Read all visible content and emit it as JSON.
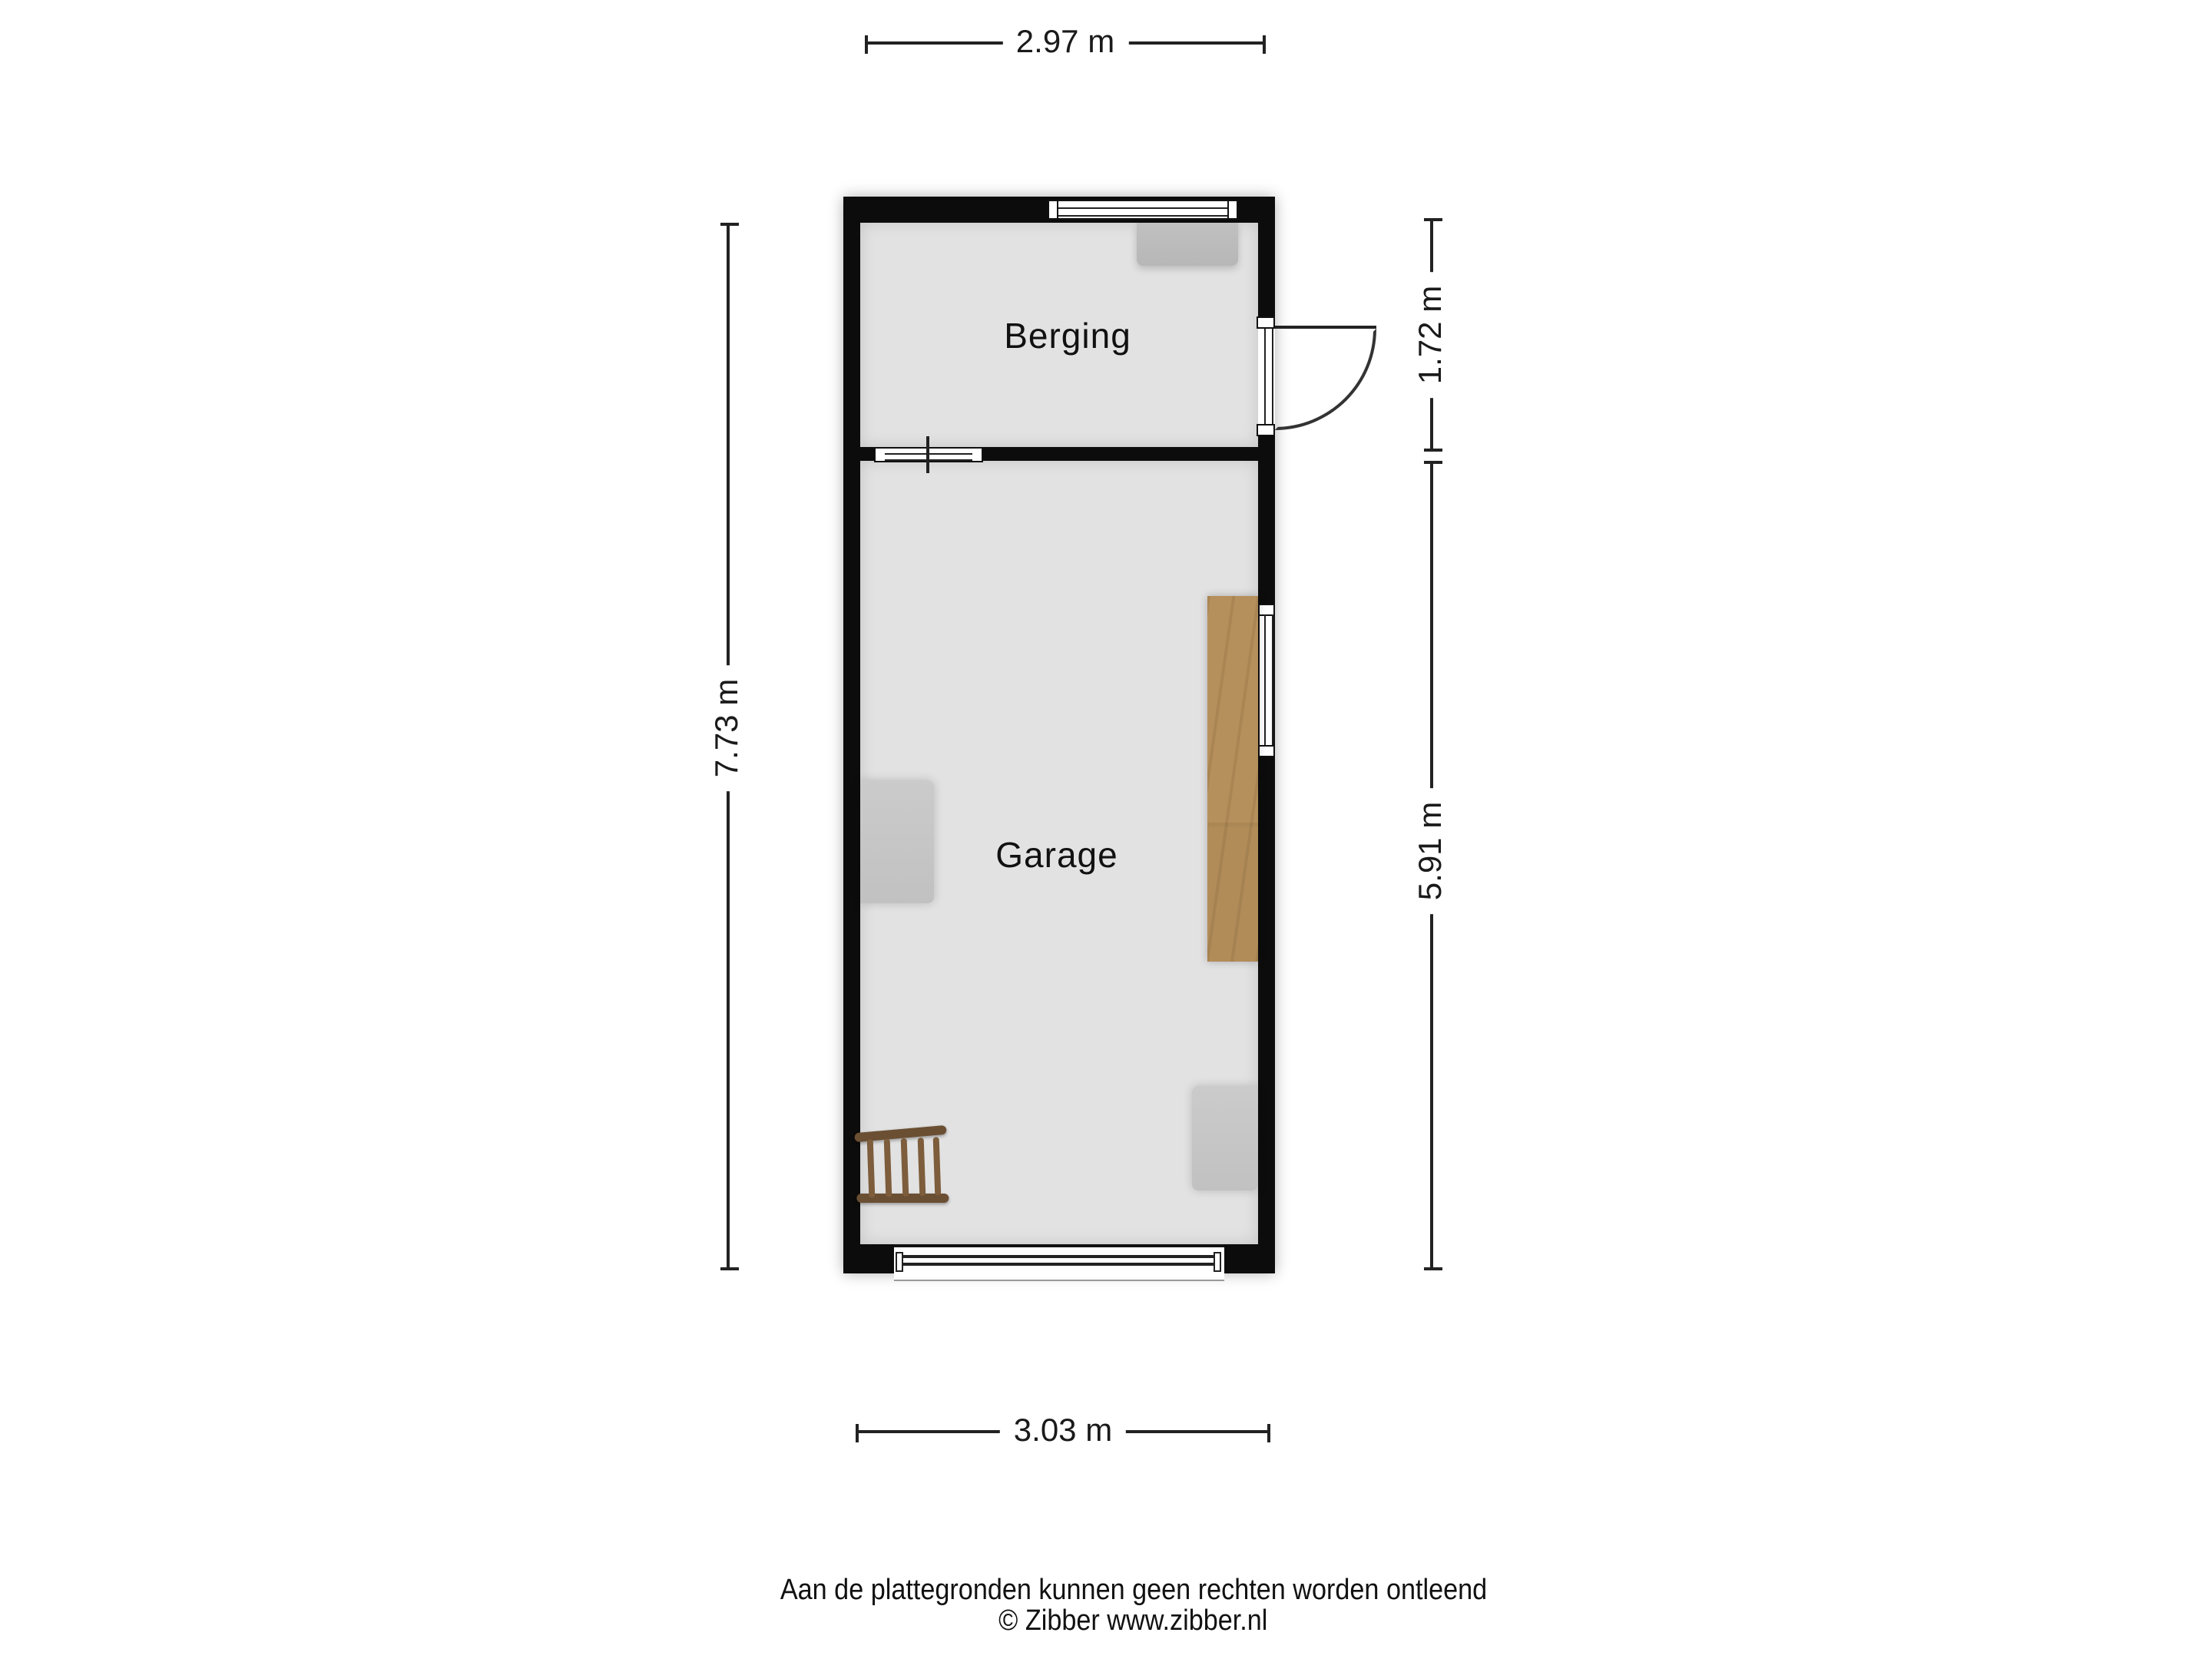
{
  "floorplan": {
    "rooms": [
      {
        "label": "Berging"
      },
      {
        "label": "Garage"
      }
    ],
    "dimensions": {
      "top": "2.97 m",
      "right_upper": "1.72 m",
      "right_lower": "5.91 m",
      "left": "7.73 m",
      "bottom": "3.03 m"
    },
    "footer": {
      "disclaimer": "Aan de plattegronden kunnen geen rechten worden ontleend",
      "credit": "© Zibber www.zibber.nl"
    },
    "colors": {
      "wall": "#0c0c0c",
      "floor": "#e2e2e2",
      "furniture_gray": "#c6c6c6",
      "workbench_wood": "#b08a58",
      "ladder_wood": "#6b4f33",
      "dimension_text": "#1a1a1a"
    }
  }
}
